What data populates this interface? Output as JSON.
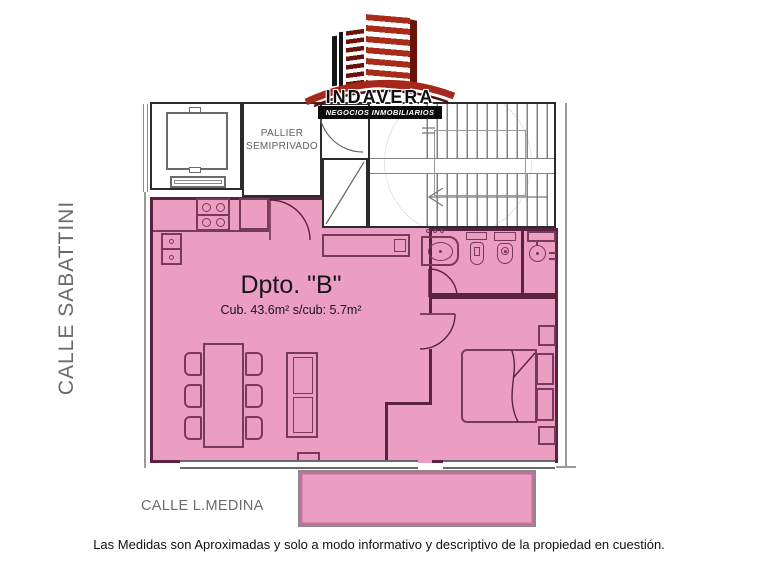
{
  "canvas": {
    "width": 758,
    "height": 564
  },
  "logo": {
    "name": "INDAVERA",
    "tagline": "NEGOCIOS INMOBILIARIOS"
  },
  "streets": {
    "left": "CALLE SABATTINI",
    "bottom": "CALLE L.MEDINA"
  },
  "unit": {
    "title": "Dpto. \"B\"",
    "area_label": "Cub. 43.6m² s/cub: 5.7m²"
  },
  "pallier": {
    "line1": "PALLIER",
    "line2": "SEMIPRIVADO"
  },
  "disclaimer": "Las Medidas son Aproximadas y solo a modo informativo y descriptivo de la propiedad en cuestión.",
  "colors": {
    "apartment_fill": "#EC9EC2",
    "apartment_wall": "#5A2240",
    "furniture_line": "#77395C",
    "outer_wall": "#2B2B2B",
    "plan_gray": "#828282",
    "light_gray": "#C8C8C8",
    "street_text": "#6B6B6B",
    "label_gray": "#5F5F5F",
    "text_dark": "#161616",
    "logo_red": "#A92C1B",
    "logo_dark_red": "#6B120A",
    "swoosh_red": "#A6281C",
    "banner_bg": "#0B0B0B",
    "balcony_inner": "#C2729B"
  }
}
